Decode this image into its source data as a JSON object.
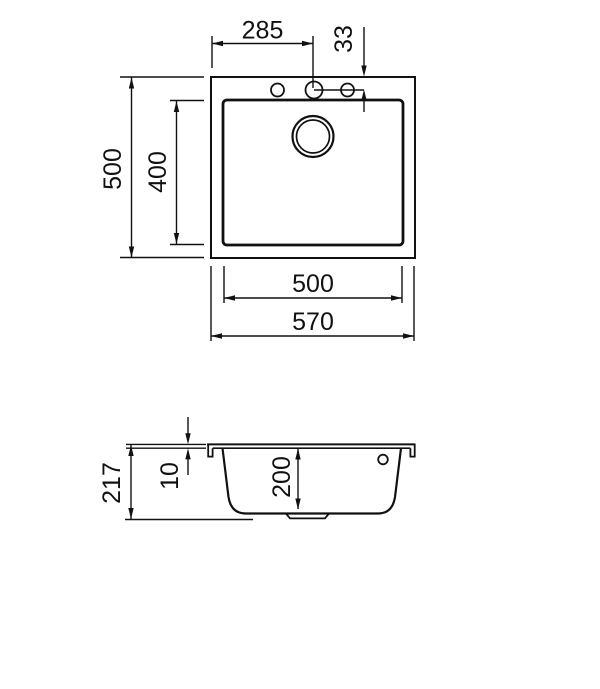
{
  "line_color": "#111111",
  "background_color": "#ffffff",
  "top_view": {
    "dim_faucet_offset_x": "285",
    "dim_faucet_offset_y": "33",
    "dim_overall_depth": "500",
    "dim_bowl_depth": "400",
    "dim_bowl_width": "500",
    "dim_overall_width": "570"
  },
  "side_view": {
    "dim_overall_height": "217",
    "dim_rim_thickness": "10",
    "dim_bowl_inner_height": "200"
  }
}
